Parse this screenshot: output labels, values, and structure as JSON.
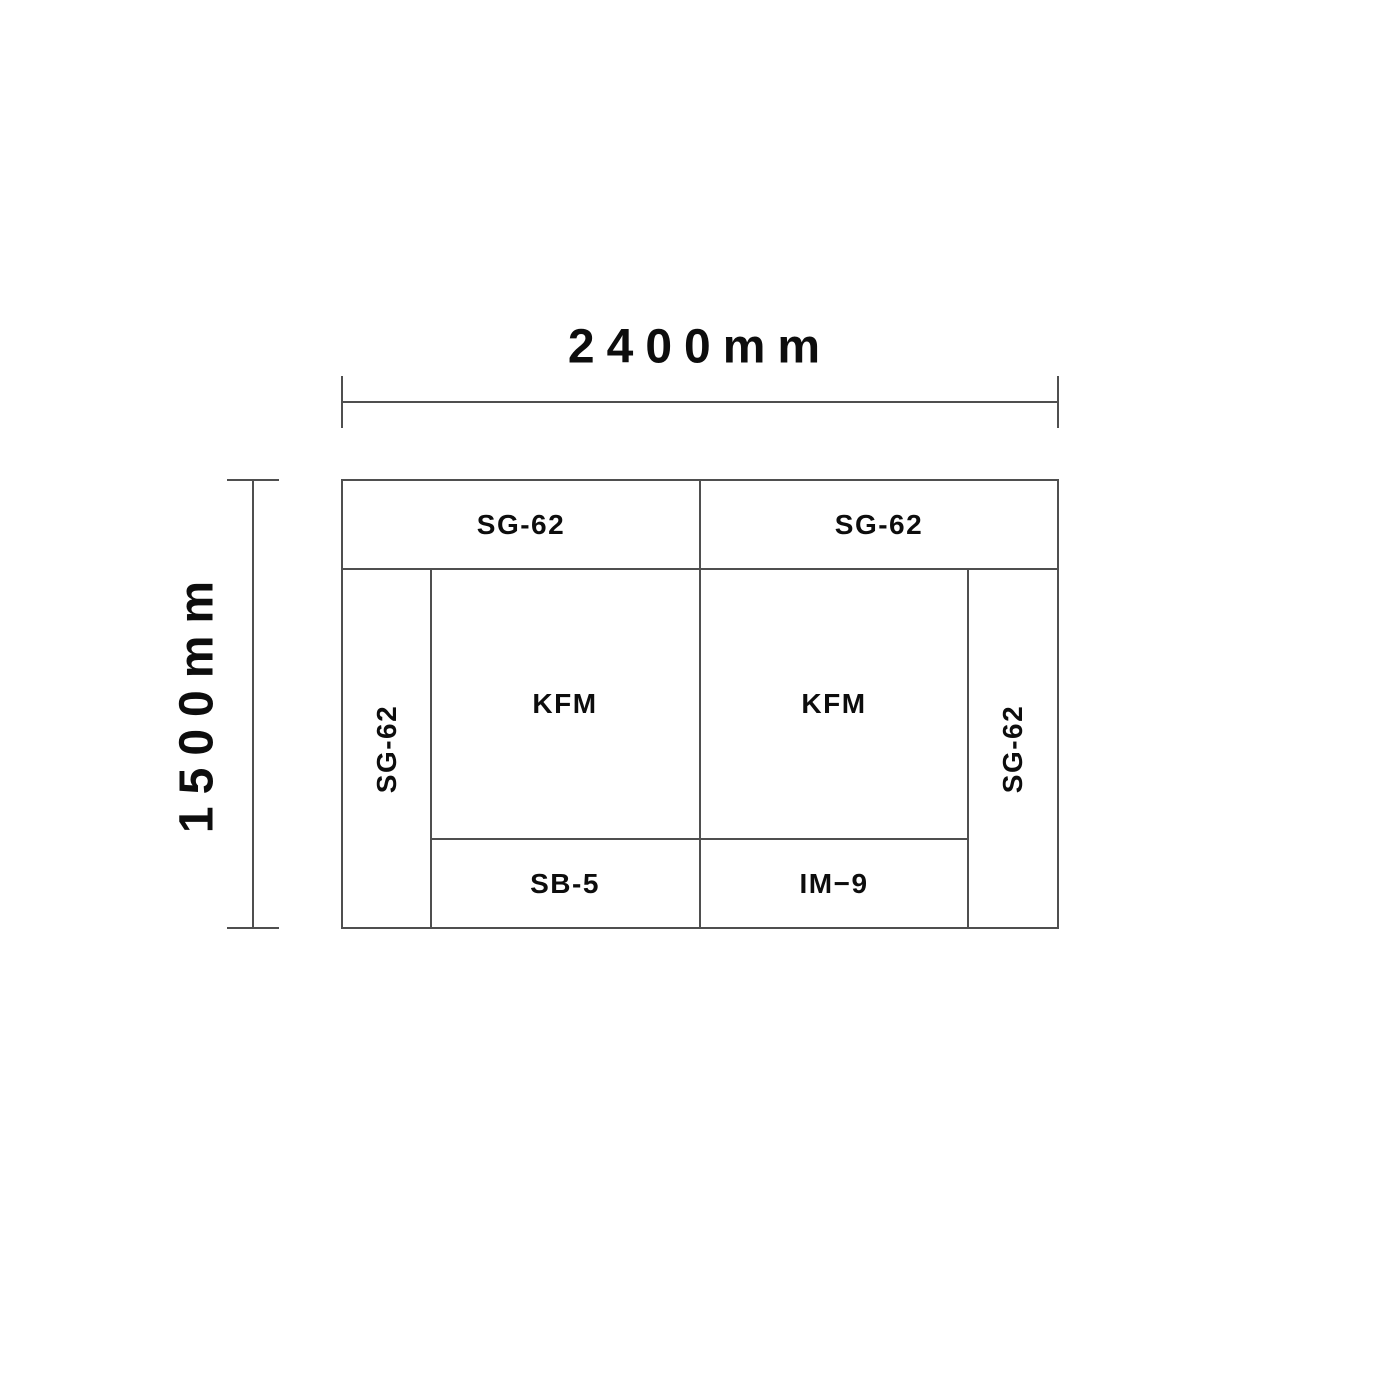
{
  "diagram": {
    "title": "panel-layout-dimension-drawing",
    "dimensions": {
      "width_label": "2400mm",
      "height_label": "1500mm",
      "width_mm": 2400,
      "height_mm": 1500
    },
    "labels": {
      "top_left": "SG-62",
      "top_right": "SG-62",
      "left_column": "SG-62",
      "right_column": "SG-62",
      "kfm_left": "KFM",
      "kfm_right": "KFM",
      "bottom_left": "SB-5",
      "bottom_right": "IM−9"
    },
    "colors": {
      "line": "#4f4f4f",
      "text": "#0d0d0d",
      "background": "#ffffff"
    }
  }
}
